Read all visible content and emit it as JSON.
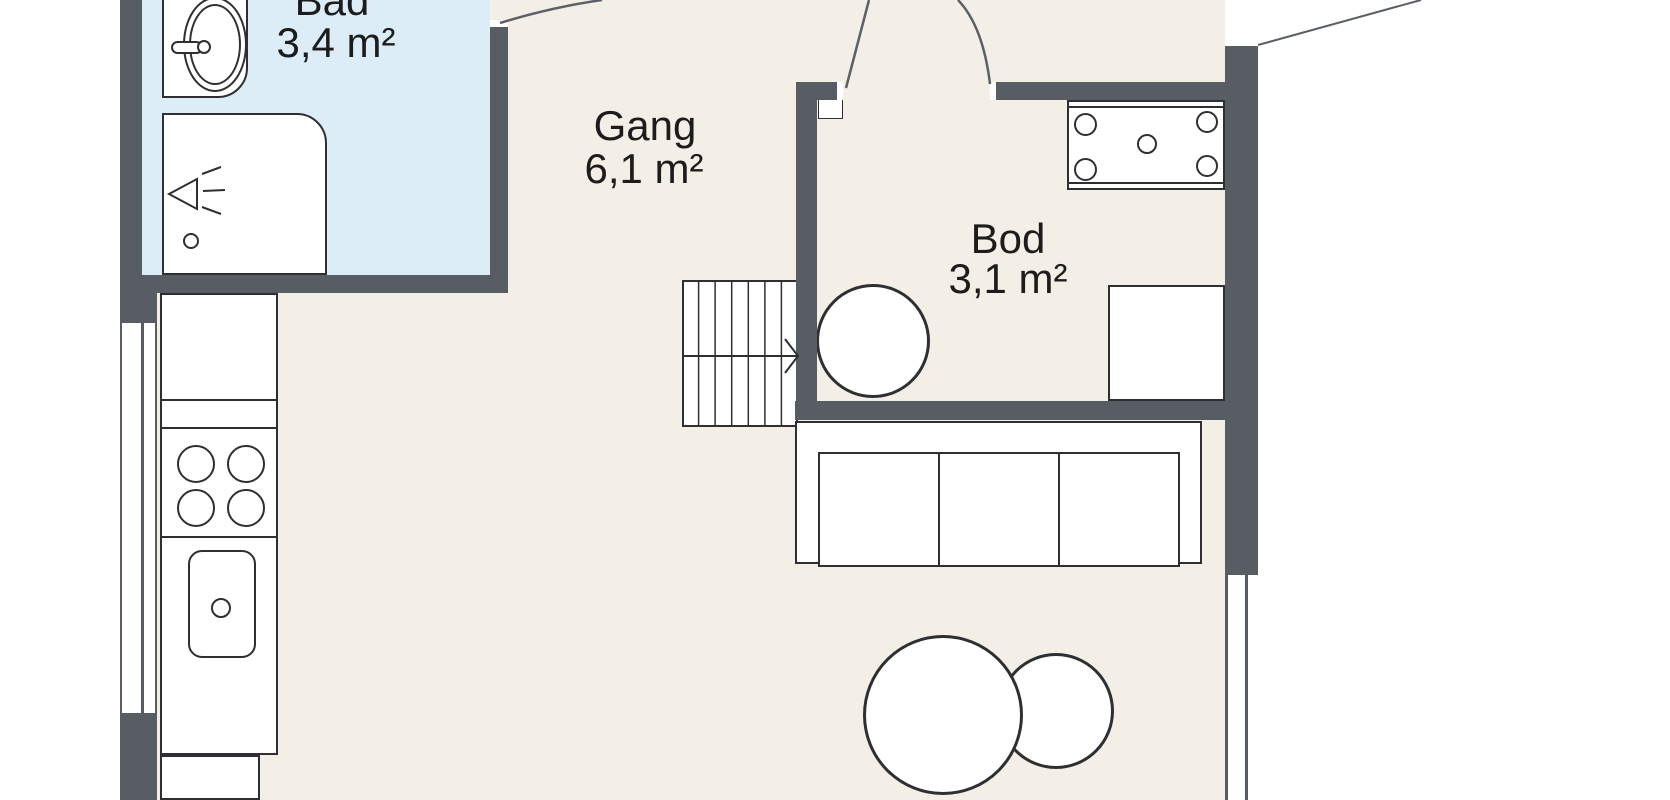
{
  "rooms": [
    {
      "id": "bad",
      "label": "Bad",
      "area": "3,4 m²",
      "floor_color": "#dcedf8"
    },
    {
      "id": "gang",
      "label": "Gang",
      "area": "6,1 m²",
      "floor_color": "#f4efe6"
    },
    {
      "id": "bod",
      "label": "Bod",
      "area": "3,1 m²",
      "floor_color": "#f4efe6"
    }
  ],
  "fixtures": [
    "bathroom-sink-oval",
    "bathroom-tap",
    "shower-cabin",
    "shower-head-symbol",
    "shower-drain",
    "kitchen-counter",
    "cooktop-4-burners",
    "kitchen-sink",
    "kitchen-sink-drain",
    "staircase-7-treads",
    "stairs-direction-arrow",
    "water-heater-circle",
    "storage-cabinet",
    "hob-unit-4-burners",
    "sofa-3-seats",
    "round-table-large",
    "round-table-small",
    "window-left",
    "window-right",
    "door-swing-bad",
    "door-swing-bod",
    "exterior-line"
  ],
  "colors": {
    "wall": "#585d64",
    "bad_floor": "#dcedf8",
    "floor": "#f4efe6",
    "outline": "#2d2f32",
    "outside": "#ffffff"
  }
}
